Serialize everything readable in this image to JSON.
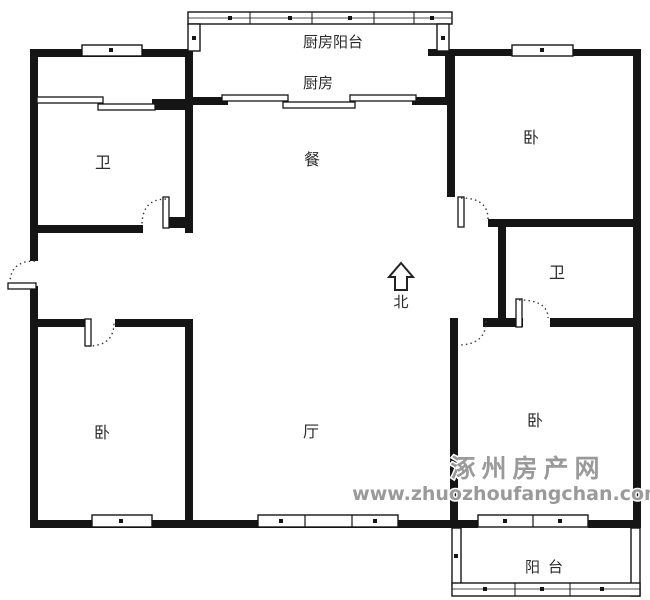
{
  "rooms": {
    "kitchen_balcony": "厨房阳台",
    "kitchen": "厨房",
    "bath_left": "卫",
    "dining": "餐",
    "bedroom_top_right": "卧",
    "bath_right": "卫",
    "bedroom_bottom_left": "卧",
    "living": "厅",
    "bedroom_bottom_right": "卧",
    "balcony": "阳台"
  },
  "compass": {
    "label": "北"
  },
  "watermark": {
    "site_name": "涿州房产网",
    "site_url": "www.zhuozhoufangchan.com",
    "color": "#9a9a9a"
  },
  "colors": {
    "wall": "#151515",
    "background": "#ffffff"
  }
}
